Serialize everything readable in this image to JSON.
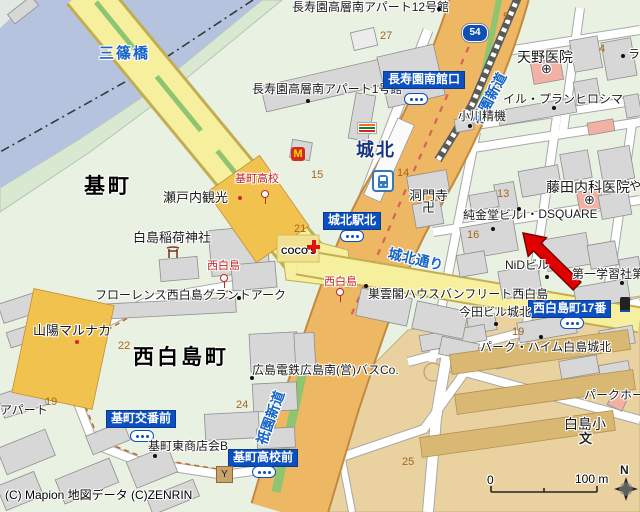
{
  "districts": {
    "motomachi": "基町",
    "nishihakushimacho": "西白島町"
  },
  "station": {
    "name": "城北"
  },
  "roads": {
    "misasa_bridge": "三篠橋",
    "gion_shindo": "祇園新道",
    "johoku_dori": "城北通り",
    "route54": "54"
  },
  "bus_stops": {
    "chojuen_minamikan": "長寿園南館口",
    "johoku_ekikita": "城北駅北",
    "nishihakushimacho17": "西白島町17番",
    "motomachi_kobanmae": "基町交番前",
    "motomachi_kokomae": "基町高校前"
  },
  "tram_stops": {
    "motomachi_koko": "基町高校",
    "nishihakushima": "西白島"
  },
  "pois": {
    "choju12": "長寿園高層南アパート12号館",
    "choju1": "長寿園高層南アパート1号館",
    "amano": "天野医院",
    "ilplan": "イル・プランヒロシマ",
    "ogawa": "小川精機",
    "fujita": "藤田内科医院",
    "dsquare": "I・DSQUARE",
    "junkindo": "純金堂ビル",
    "domonji": "洞門寺",
    "nid": "NiDビル",
    "daiichi": "第一学習社第",
    "setouchi": "瀬戸内観光",
    "inari": "白島稲荷神社",
    "florence": "フローレンス西白島グラントアーク",
    "sanyo_marunaka": "山陽マルナカ",
    "souunkaku": "巣雲閣ハウスバンフリート西白島",
    "imada": "今田ビル城北",
    "hiroden_bus": "広島電鉄広島南(営)バスCo.",
    "shotenkai": "基町東商店会B",
    "parkheim": "パーク・ハイム白島城北",
    "parkho": "パークホー",
    "hakushima_sho": "白島小",
    "apart": "アパート",
    "partial_ra": "ラ",
    "partial_ya": "や",
    "cocos": "COCO'S"
  },
  "symbols": {
    "temple": "卍",
    "school": "文",
    "hospital": "⊕",
    "y_building": "Y",
    "north": "N",
    "mcdonalds": "M"
  },
  "numbers": {
    "n27": "27",
    "n5": "5",
    "n4": "4",
    "n15": "15",
    "n14": "14",
    "n13": "13",
    "n16": "16",
    "n21": "21",
    "n22": "22",
    "n19a": "19",
    "n19b": "19",
    "n24": "24",
    "n25": "25"
  },
  "scale": {
    "zero": "0",
    "hundred": "100 m"
  },
  "copyright": "(C) Mapion  地図データ (C)ZENRIN",
  "colors": {
    "water": "#b5c3de",
    "road_yellow": "#f6ef9e",
    "road_orange": "#eeb763",
    "median_green": "#8fc571",
    "badge_blue": "#0b4fc0",
    "arrow_red": "#e00000",
    "building_gray": "#d7d7d7",
    "facility_orange": "#f2c24e",
    "hospital_pink": "#f3b0a5"
  }
}
